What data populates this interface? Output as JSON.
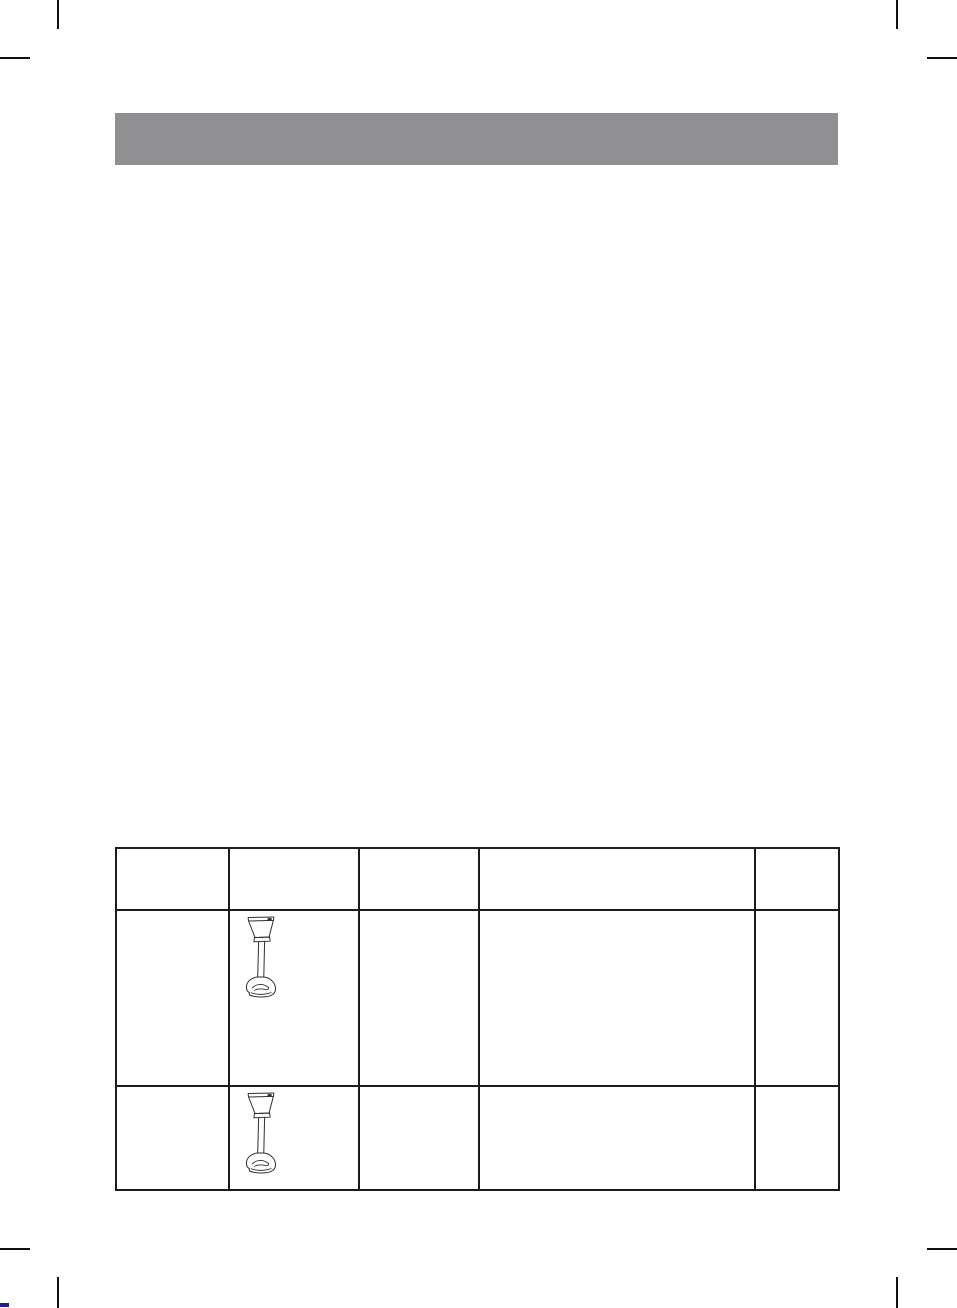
{
  "page": {
    "background_color": "#FFFFFF",
    "header_bar": {
      "text": "",
      "background_color": "#908F91"
    },
    "print_marks": {
      "crop_mark_color": "#111111",
      "corners": [
        "top-left",
        "top-right",
        "bottom-left",
        "bottom-right"
      ],
      "registration_mark_color": "#20208C"
    }
  },
  "illustrations": {
    "stroke_color": "#2F2F2F",
    "button_fill_color": "#303030"
  },
  "table": {
    "border_color": "#1B1B1B",
    "column_count": 5,
    "header_row": {
      "cells": [
        "",
        "",
        "",
        "",
        ""
      ]
    },
    "body_rows": [
      {
        "cells": [
          {
            "text": ""
          },
          {
            "text": "",
            "icon": "hand-blender-illustration"
          },
          {
            "text": ""
          },
          {
            "text": ""
          },
          {
            "text": ""
          }
        ]
      },
      {
        "cells": [
          {
            "text": ""
          },
          {
            "text": "",
            "icon": "hand-blender-illustration"
          },
          {
            "text": ""
          },
          {
            "text": ""
          },
          {
            "text": ""
          }
        ]
      }
    ]
  }
}
